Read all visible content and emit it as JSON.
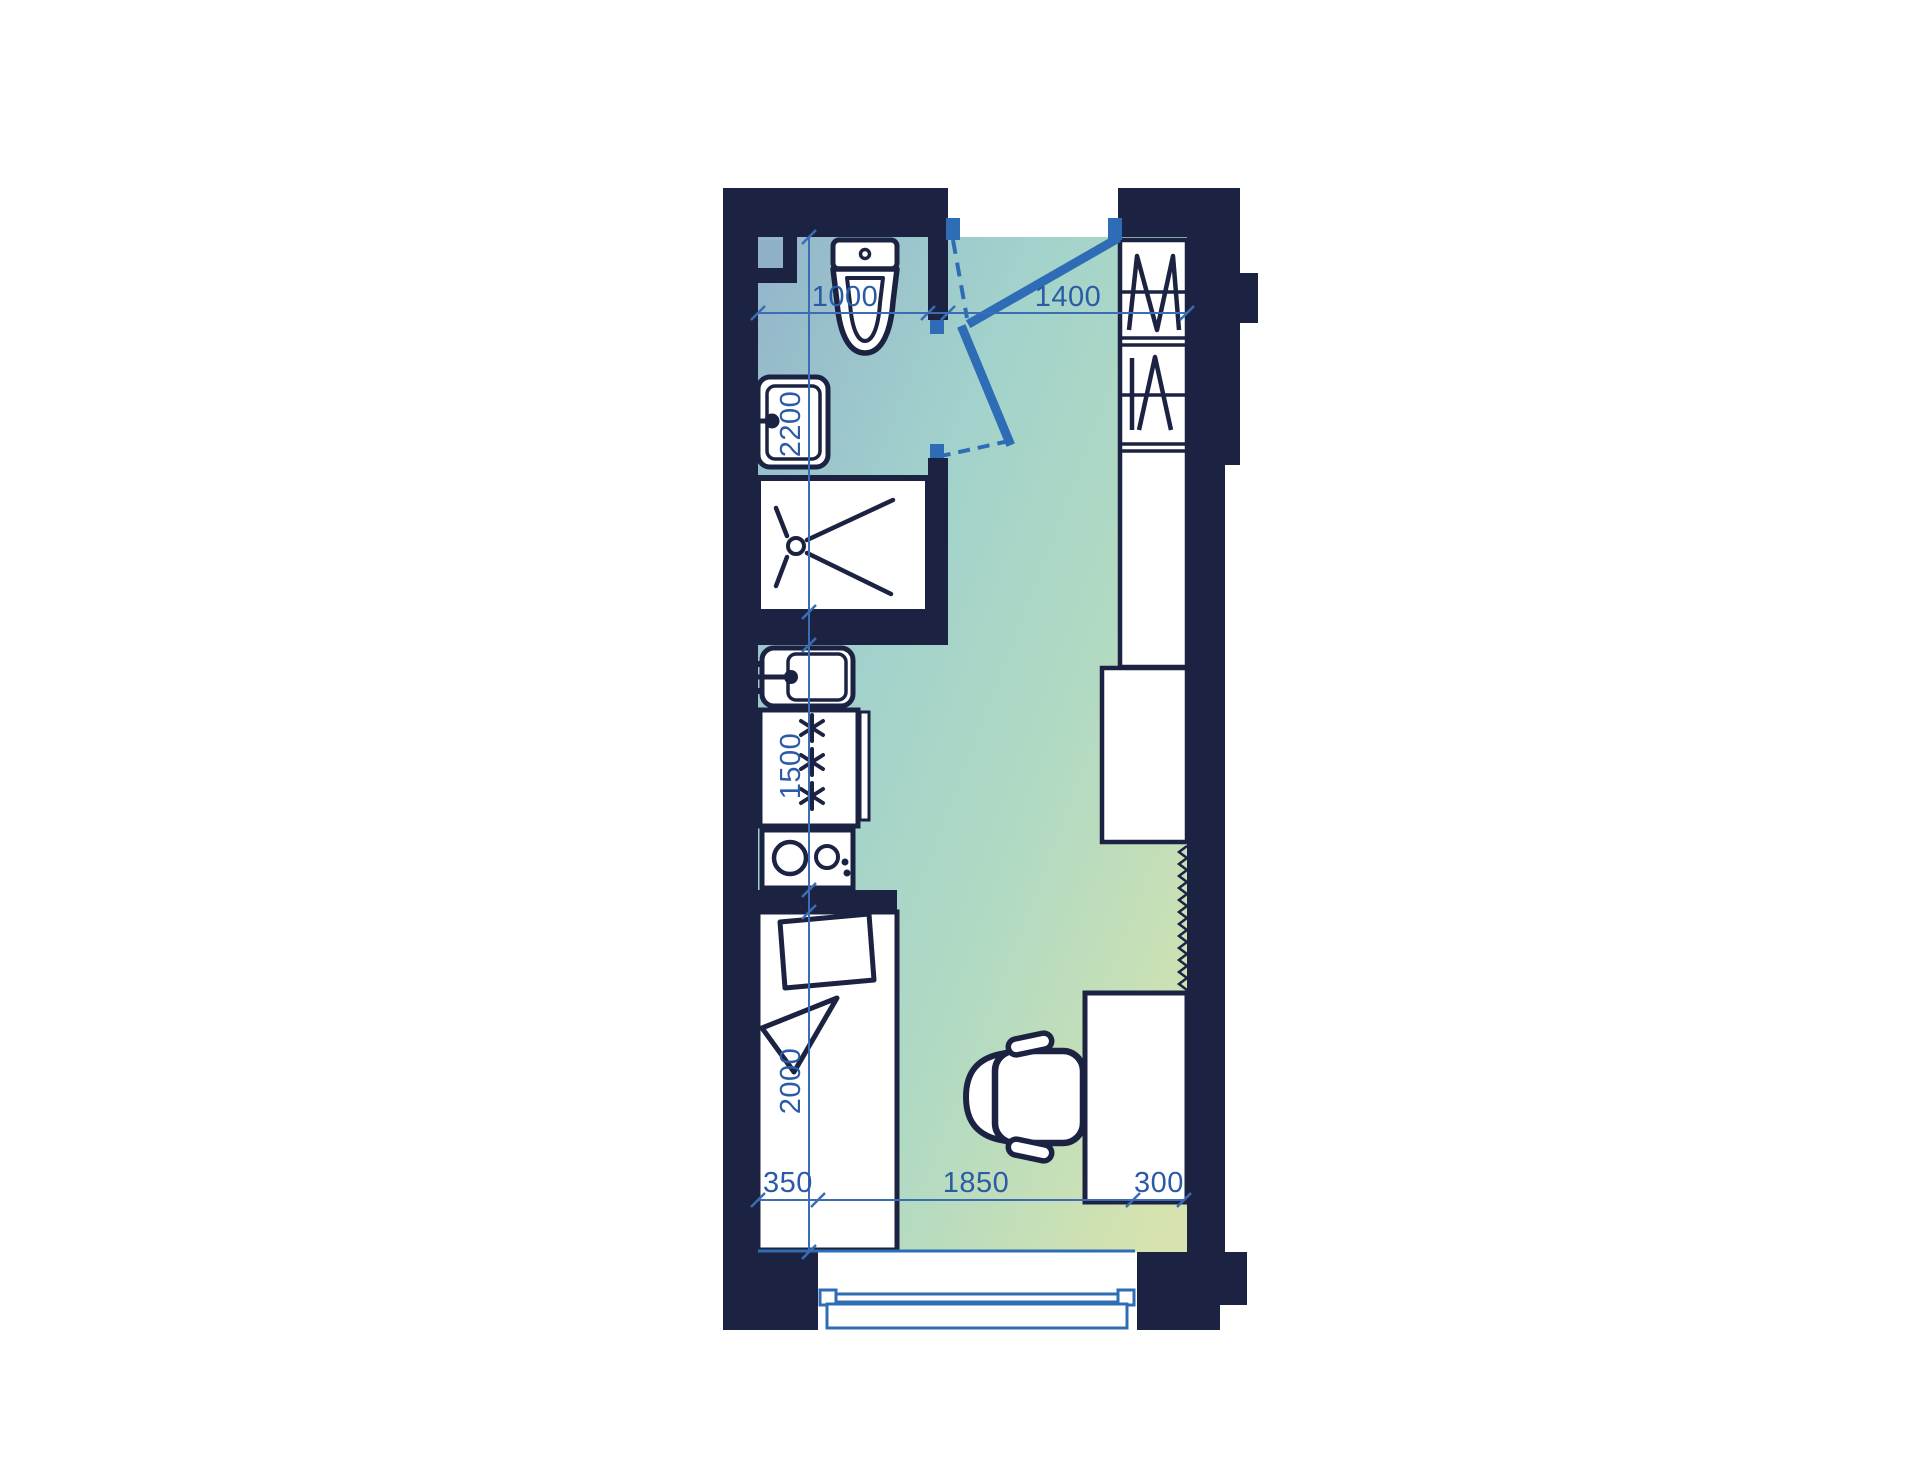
{
  "title": "Studio apartment floor plan",
  "colors": {
    "wall": "#1c2342",
    "accent": "#2e6db6",
    "dim_line": "#3a6db4",
    "dim_text": "#2b5ba6",
    "shaft": "#8fb0c7",
    "fixture": "#ffffff",
    "bg": "#ffffff",
    "floor_start": "#93b5cb",
    "floor_mid1": "#a2d2cc",
    "floor_mid2": "#b2dac2",
    "floor_end": "#d6e3ae"
  },
  "dimensions": {
    "top": [
      {
        "label": "1000"
      },
      {
        "label": "1400"
      }
    ],
    "left": [
      {
        "label": "2200"
      },
      {
        "label": "1500"
      },
      {
        "label": "2000"
      }
    ],
    "bottom": [
      {
        "label": "350"
      },
      {
        "label": "1850"
      },
      {
        "label": "300"
      }
    ]
  },
  "fixtures": [
    "toilet",
    "washbasin",
    "shower-tray",
    "ventilation-shaft",
    "kitchen-sink",
    "refrigerator",
    "stove",
    "bed-with-pillow",
    "wardrobe-hanging-sections",
    "tall-cabinet",
    "desk",
    "office-chair",
    "entry-door",
    "bathroom-door",
    "window-with-sill"
  ]
}
